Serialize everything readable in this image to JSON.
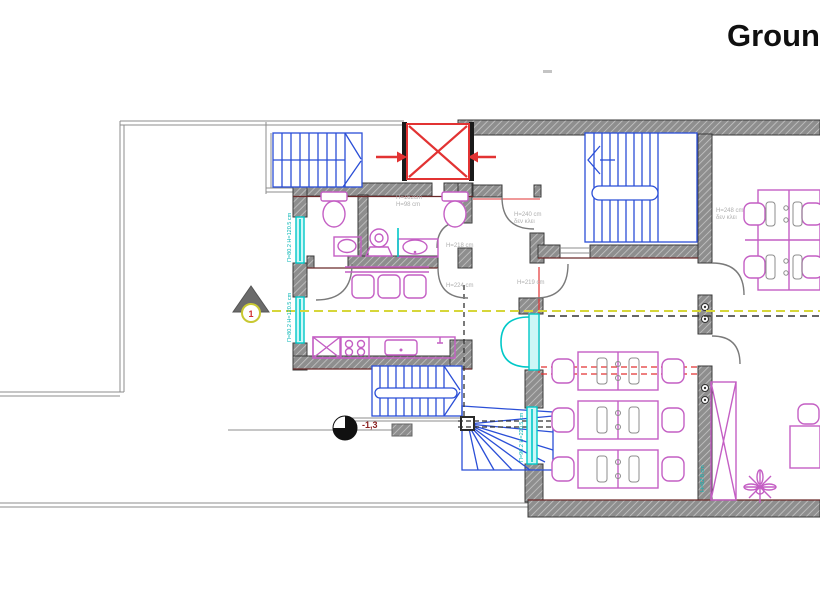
{
  "title": "Ground",
  "markers": {
    "section_number": "1",
    "level_value": "-1,3"
  },
  "labels": {
    "wc_width": "Π=162cm",
    "wc_height": "H=98 cm",
    "door_h_218": "H=218 cm",
    "door_h_224": "H=224 cm",
    "door_h_240": "H=240 cm",
    "door_h_240_note": "δεν κλει",
    "door_h_219": "H=219 cm",
    "door_h_248": "H=248 cm",
    "door_h_248_note": "δεν κλει",
    "window_left_upper": "Π=80.2 H=120.5 cm",
    "window_left_lower": "Π=80.2 H=120.5 cm",
    "window_corridor": "Π=90.2 H=220.5 cm",
    "window_right": "H=82.8 cm"
  },
  "symbols": {
    "stairs": "blue-hatched-stair",
    "elevator": "red-cross-shaft",
    "window": "cyan-strip",
    "section_line": "yellow-dashed",
    "furniture": "magenta-outline"
  },
  "colors": {
    "wall_gray": "#8e8e8e",
    "stair_blue": "#2b4fd7",
    "fixture_magenta": "#c45fc4",
    "window_cyan": "#00c8c8",
    "section_yellow": "#d6d63a",
    "alert_red": "#e23333"
  }
}
